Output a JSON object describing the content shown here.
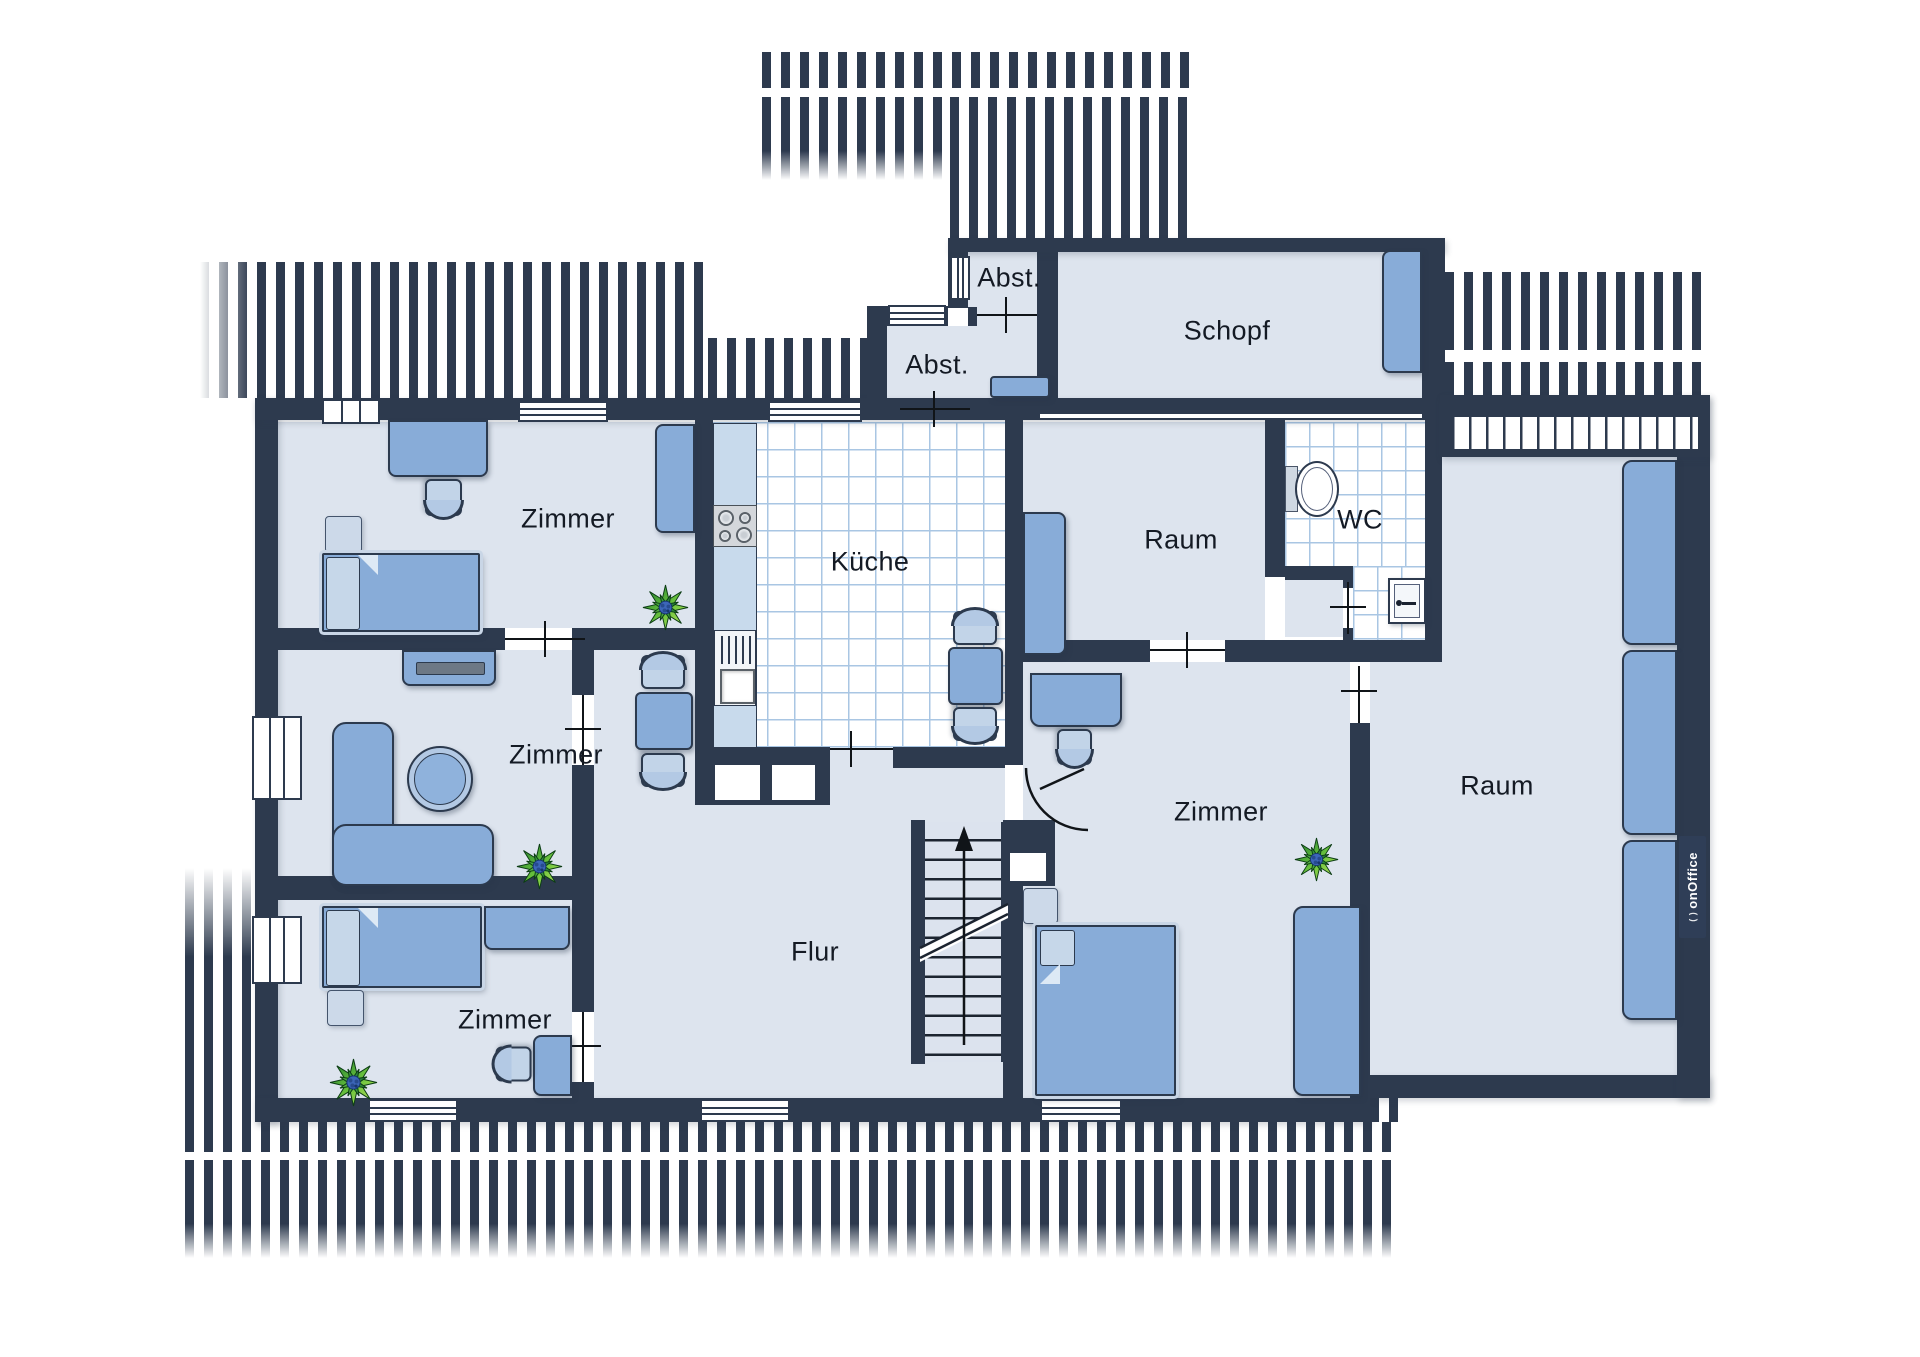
{
  "plan": {
    "type": "floorplan",
    "rooms": [
      {
        "id": "abst-upper",
        "label": "Abst."
      },
      {
        "id": "abst-lower",
        "label": "Abst."
      },
      {
        "id": "schopf",
        "label": "Schopf"
      },
      {
        "id": "zimmer-top-left",
        "label": "Zimmer"
      },
      {
        "id": "kueche",
        "label": "Küche"
      },
      {
        "id": "raum-middle",
        "label": "Raum"
      },
      {
        "id": "wc",
        "label": "WC"
      },
      {
        "id": "zimmer-middle-left",
        "label": "Zimmer"
      },
      {
        "id": "zimmer-right",
        "label": "Zimmer"
      },
      {
        "id": "raum-right",
        "label": "Raum"
      },
      {
        "id": "zimmer-bottom-left",
        "label": "Zimmer"
      },
      {
        "id": "flur",
        "label": "Flur"
      }
    ]
  },
  "watermark": {
    "brand": "onOffice",
    "icon": "( )"
  },
  "colors": {
    "wall": "#2d3a4e",
    "floor": "#dde4ee",
    "tile_line": "#a9c6e3",
    "furniture_blue": "#88acd8",
    "furniture_light_blue": "#c2d4e8",
    "plant_green": "#57b33e",
    "plant_center_blue": "#3c66b8",
    "door_line": "#101418"
  }
}
